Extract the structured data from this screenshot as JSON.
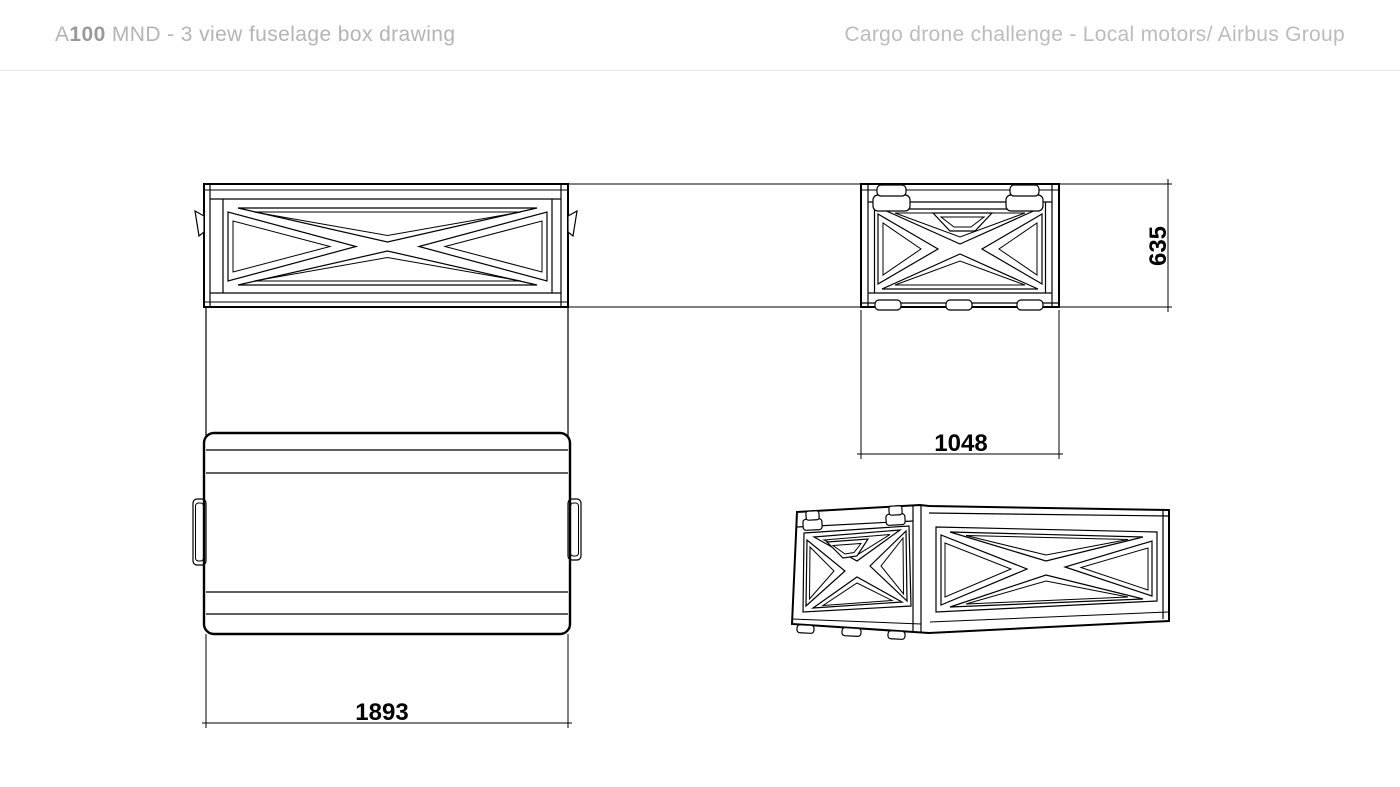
{
  "header": {
    "title_prefix": "A",
    "title_bold": "100",
    "title_rest": " MND - 3 view fuselage box drawing",
    "subtitle": "Cargo drone challenge - Local motors/ Airbus Group"
  },
  "drawing": {
    "dimensions": {
      "height": "635",
      "width": "1048",
      "length": "1893"
    }
  },
  "colors": {
    "background": "#ffffff",
    "line": "#000000",
    "header_text": "#b4b4b4",
    "header_accent": "#9a9a9a",
    "divider": "#e4e4e4"
  }
}
